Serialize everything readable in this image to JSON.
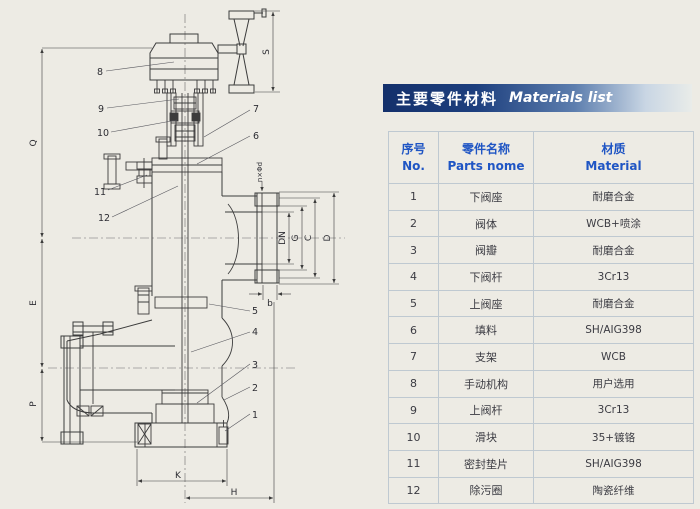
{
  "header": {
    "title_zh": "主要零件材料",
    "title_en": "Materials list"
  },
  "table": {
    "columns": [
      {
        "zh": "序号",
        "en": "No."
      },
      {
        "zh": "零件名称",
        "en": "Parts nome"
      },
      {
        "zh": "材质",
        "en": "Material"
      }
    ],
    "rows": [
      {
        "no": "1",
        "part": "下阀座",
        "material": "耐磨合金"
      },
      {
        "no": "2",
        "part": "阀体",
        "material": "WCB+喷涂"
      },
      {
        "no": "3",
        "part": "阀瓣",
        "material": "耐磨合金"
      },
      {
        "no": "4",
        "part": "下阀杆",
        "material": "3Cr13"
      },
      {
        "no": "5",
        "part": "上阀座",
        "material": "耐磨合金"
      },
      {
        "no": "6",
        "part": "填料",
        "material": "SH/AIG398"
      },
      {
        "no": "7",
        "part": "支架",
        "material": "WCB"
      },
      {
        "no": "8",
        "part": "手动机构",
        "material": "用户选用"
      },
      {
        "no": "9",
        "part": "上阀杆",
        "material": "3Cr13"
      },
      {
        "no": "10",
        "part": "滑块",
        "material": "35+镀铬"
      },
      {
        "no": "11",
        "part": "密封垫片",
        "material": "SH/AIG398"
      },
      {
        "no": "12",
        "part": "除污圈",
        "material": "陶瓷纤维"
      }
    ]
  },
  "drawing": {
    "part_numbers": [
      "1",
      "2",
      "3",
      "4",
      "5",
      "6",
      "7",
      "8",
      "9",
      "10",
      "11",
      "12"
    ],
    "dimensions": {
      "S": "S",
      "Q": "Q",
      "E": "E",
      "P": "P",
      "DN": "DN",
      "G": "G",
      "C": "C",
      "D": "D",
      "b": "b",
      "K": "K",
      "H": "H",
      "bolt_holes": "n×Φd"
    }
  },
  "colors": {
    "accent_blue": "#1f55c4",
    "bar_dark_blue": "#14306b",
    "line_art": "#3c3c3c",
    "paper": "#edebe4"
  }
}
